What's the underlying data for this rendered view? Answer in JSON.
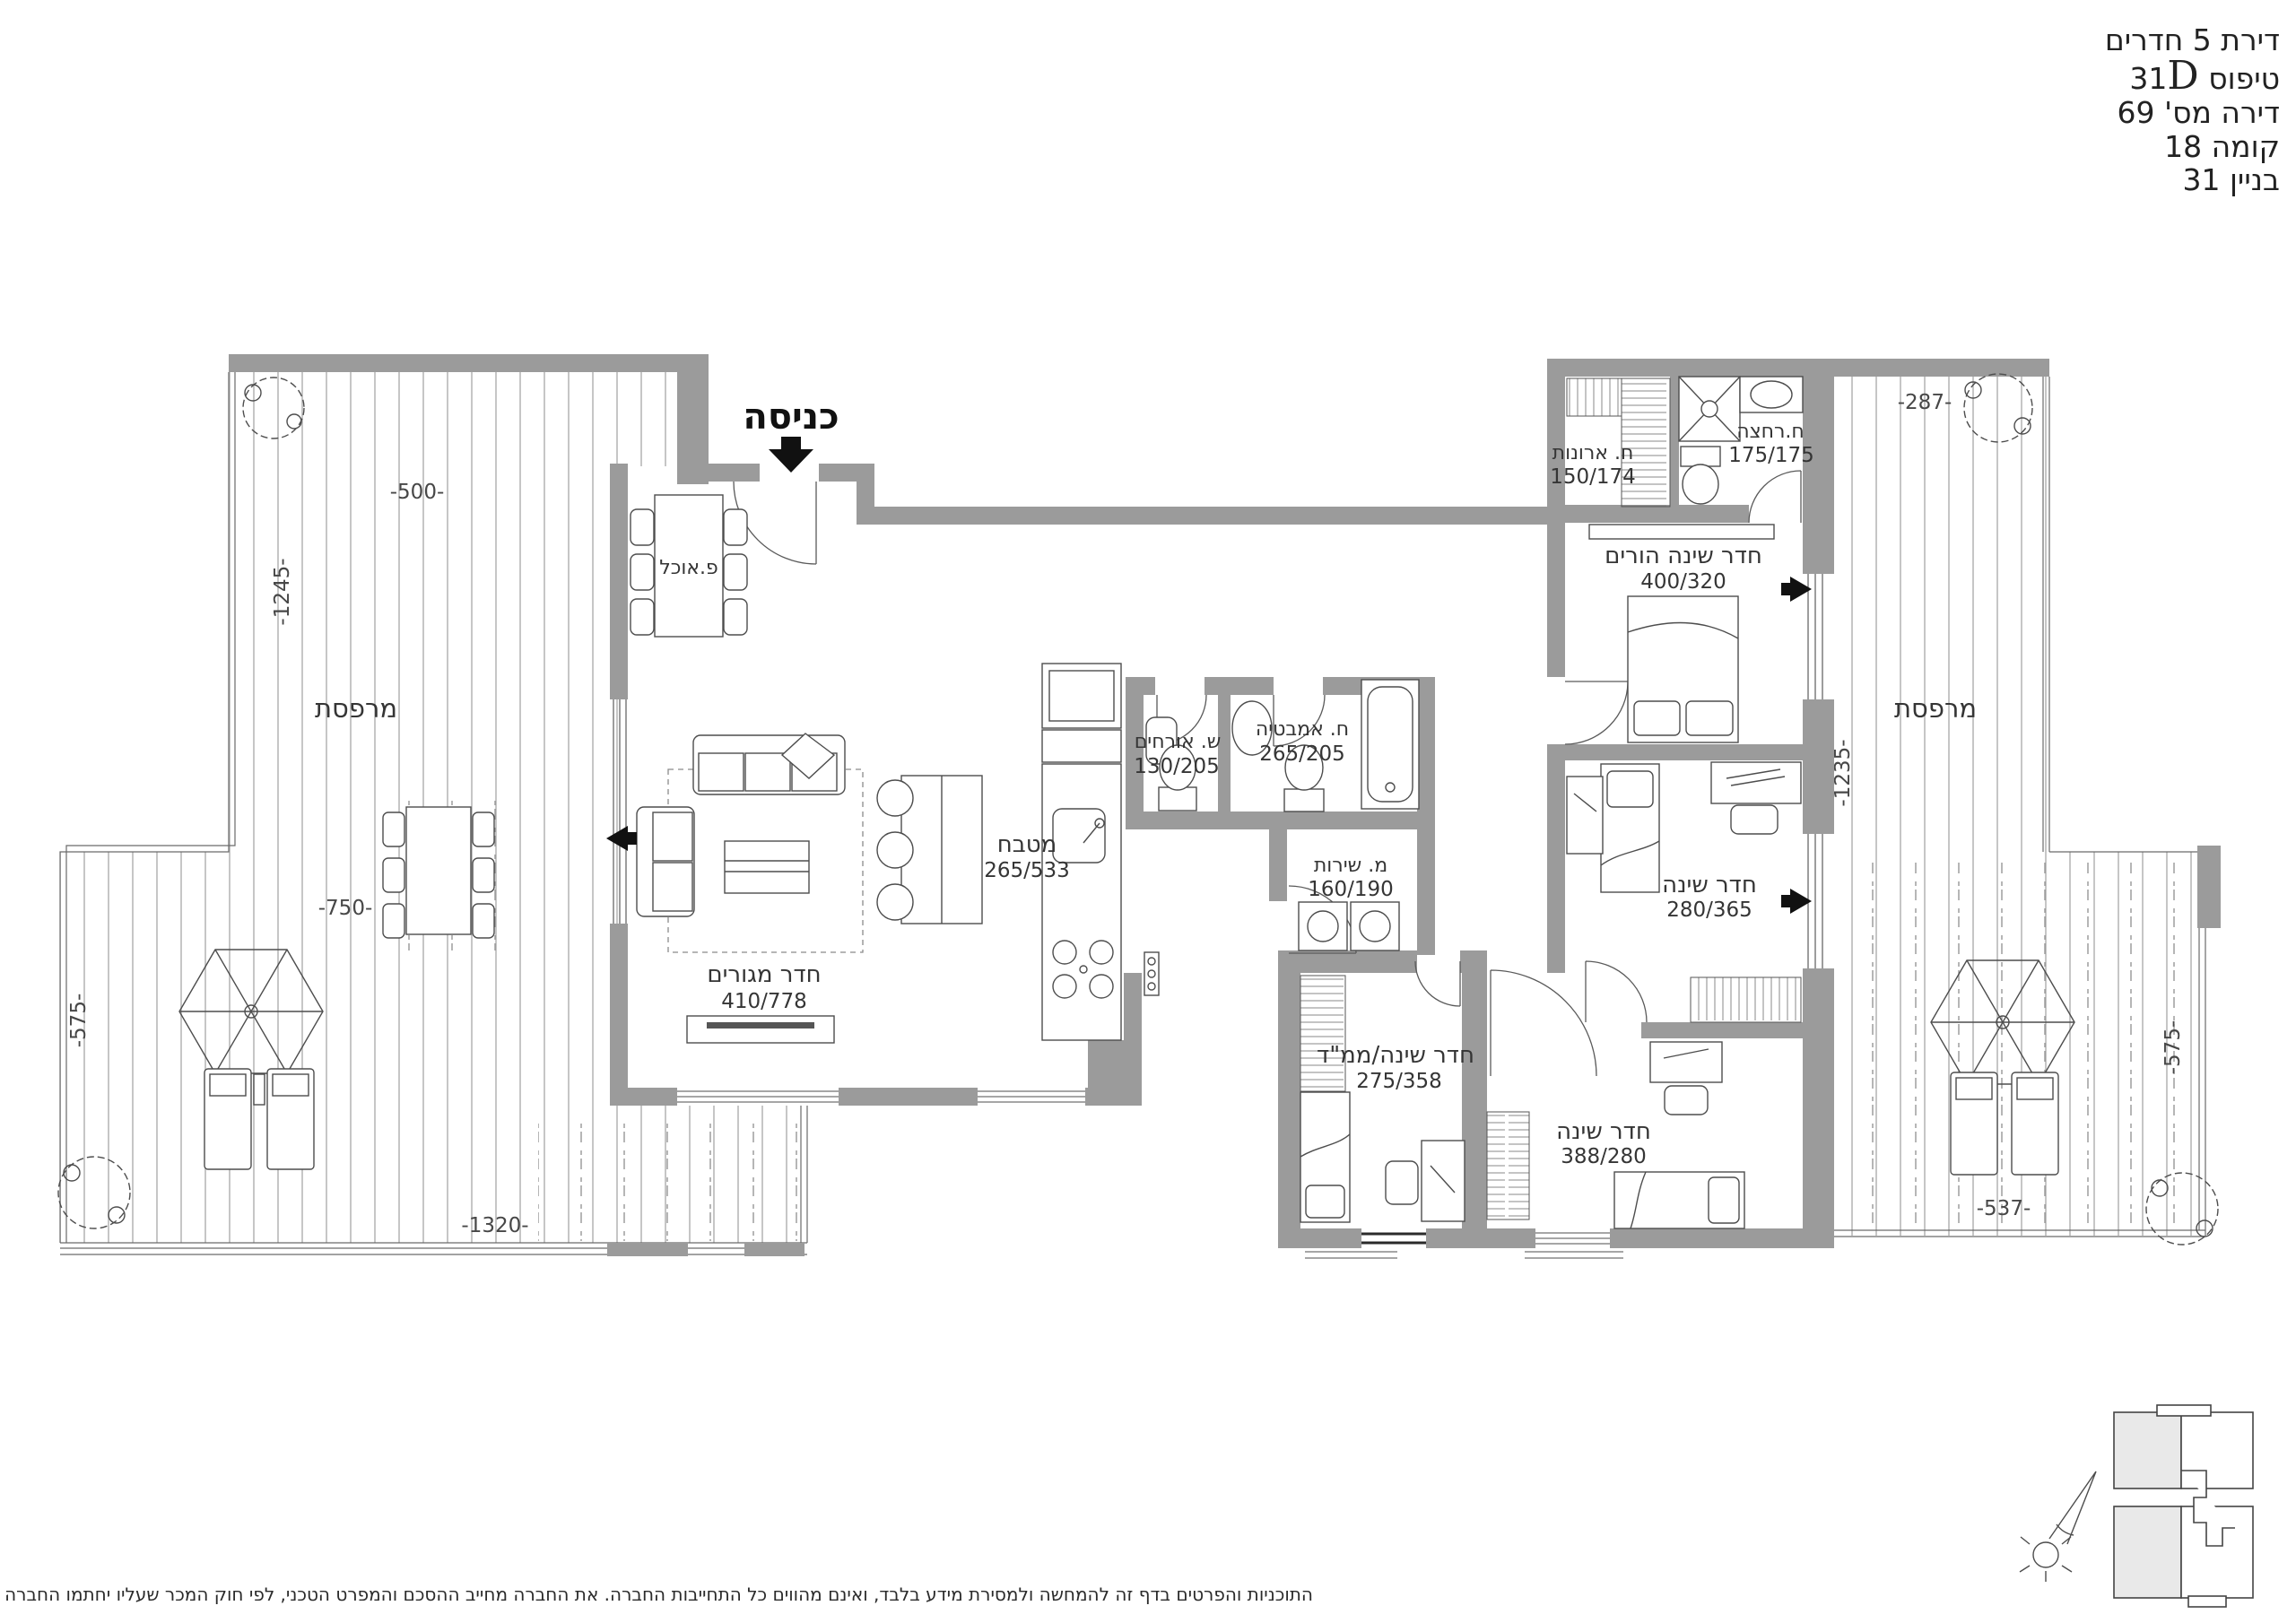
{
  "title_block": {
    "apartment_type": "דירת 5 חדרים",
    "type_label": "טיפוס",
    "type_number": "31",
    "type_letter": "D",
    "apartment_no": "דירה מס' 69",
    "floor": "קומה 18",
    "building": "בניין 31"
  },
  "entrance_label": "כניסה",
  "rooms": {
    "dining": {
      "name": "פ.אוכל"
    },
    "living": {
      "name": "חדר מגורים",
      "size": "410/778"
    },
    "kitchen": {
      "name": "מטבח",
      "size": "265/533"
    },
    "guest_wc": {
      "name": "ש. אורחים",
      "size": "130/205"
    },
    "bathroom": {
      "name": "ח. אמבטיה",
      "size": "265/205"
    },
    "utility": {
      "name": "מ. שירות",
      "size": "160/190"
    },
    "closets": {
      "name": "ח. ארונות",
      "size": "150/174"
    },
    "shower": {
      "name": "ח.רחצה",
      "size": "175/175"
    },
    "master_bedroom": {
      "name": "חדר שינה הורים",
      "size": "400/320"
    },
    "bedroom_right": {
      "name": "חדר שינה",
      "size": "280/365"
    },
    "bedroom_mamad": {
      "name": "חדר שינה/ממ\"ד",
      "size": "275/358"
    },
    "bedroom_bottom": {
      "name": "חדר שינה",
      "size": "388/280"
    },
    "terrace_left": {
      "name": "מרפסת"
    },
    "terrace_right": {
      "name": "מרפסת"
    }
  },
  "dims": {
    "left_top": "-500-",
    "left_height": "-1245-",
    "left_mid": "-750-",
    "left_side": "-575-",
    "left_bottom": "-1320-",
    "right_top": "-287-",
    "right_height": "-1235-",
    "right_side": "-575-",
    "right_bottom": "-537-"
  },
  "disclaimer": "התוכניות והפרטים בדף זה להמחשה ולמסירת מידע בלבד, ואינם מהווים כל התחייבות החברה. את החברה מחייב ההסכם והמפרט הטכני, לפי חוק המכר שעליו יחתמו החברה והרוכשים.",
  "colors": {
    "wall": "#9b9b9b",
    "line": "#4d4d4d",
    "deck_line": "#b4b4b4",
    "text": "#353535",
    "arrow": "#111111"
  }
}
